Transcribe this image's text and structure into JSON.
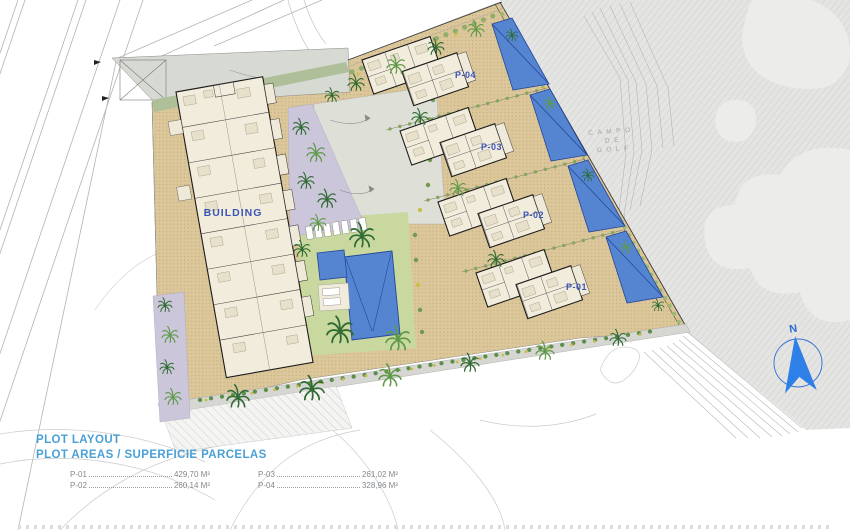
{
  "plan": {
    "building_label": "BUILDING",
    "plots": [
      {
        "label": "P-01"
      },
      {
        "label": "P-02"
      },
      {
        "label": "P-03"
      },
      {
        "label": "P-04"
      }
    ],
    "golf_label_lines": [
      "CAMPO",
      "DE",
      "GOLF"
    ],
    "compass_label": "N"
  },
  "legend": {
    "title": "PLOT LAYOUT",
    "subtitle": "PLOT AREAS / SUPERFICIE PARCELAS",
    "items": [
      {
        "label": "P-01",
        "value": "429,70 M²"
      },
      {
        "label": "P-02",
        "value": "260,14 M²"
      },
      {
        "label": "P-03",
        "value": "261,02 M²"
      },
      {
        "label": "P-04",
        "value": "328,96 M²"
      }
    ]
  },
  "colors": {
    "legend-blue": "#4AA0D4",
    "label-blue": "#3A55B8",
    "pool-blue": "#5585D0",
    "pool-border": "#23479B",
    "site-beige": "#DCC79B",
    "lawn-green": "#C9D89E",
    "golf-gray": "#E4E4E2",
    "compass-blue": "#2E7FE8",
    "palm-green": "#2F6B33"
  }
}
